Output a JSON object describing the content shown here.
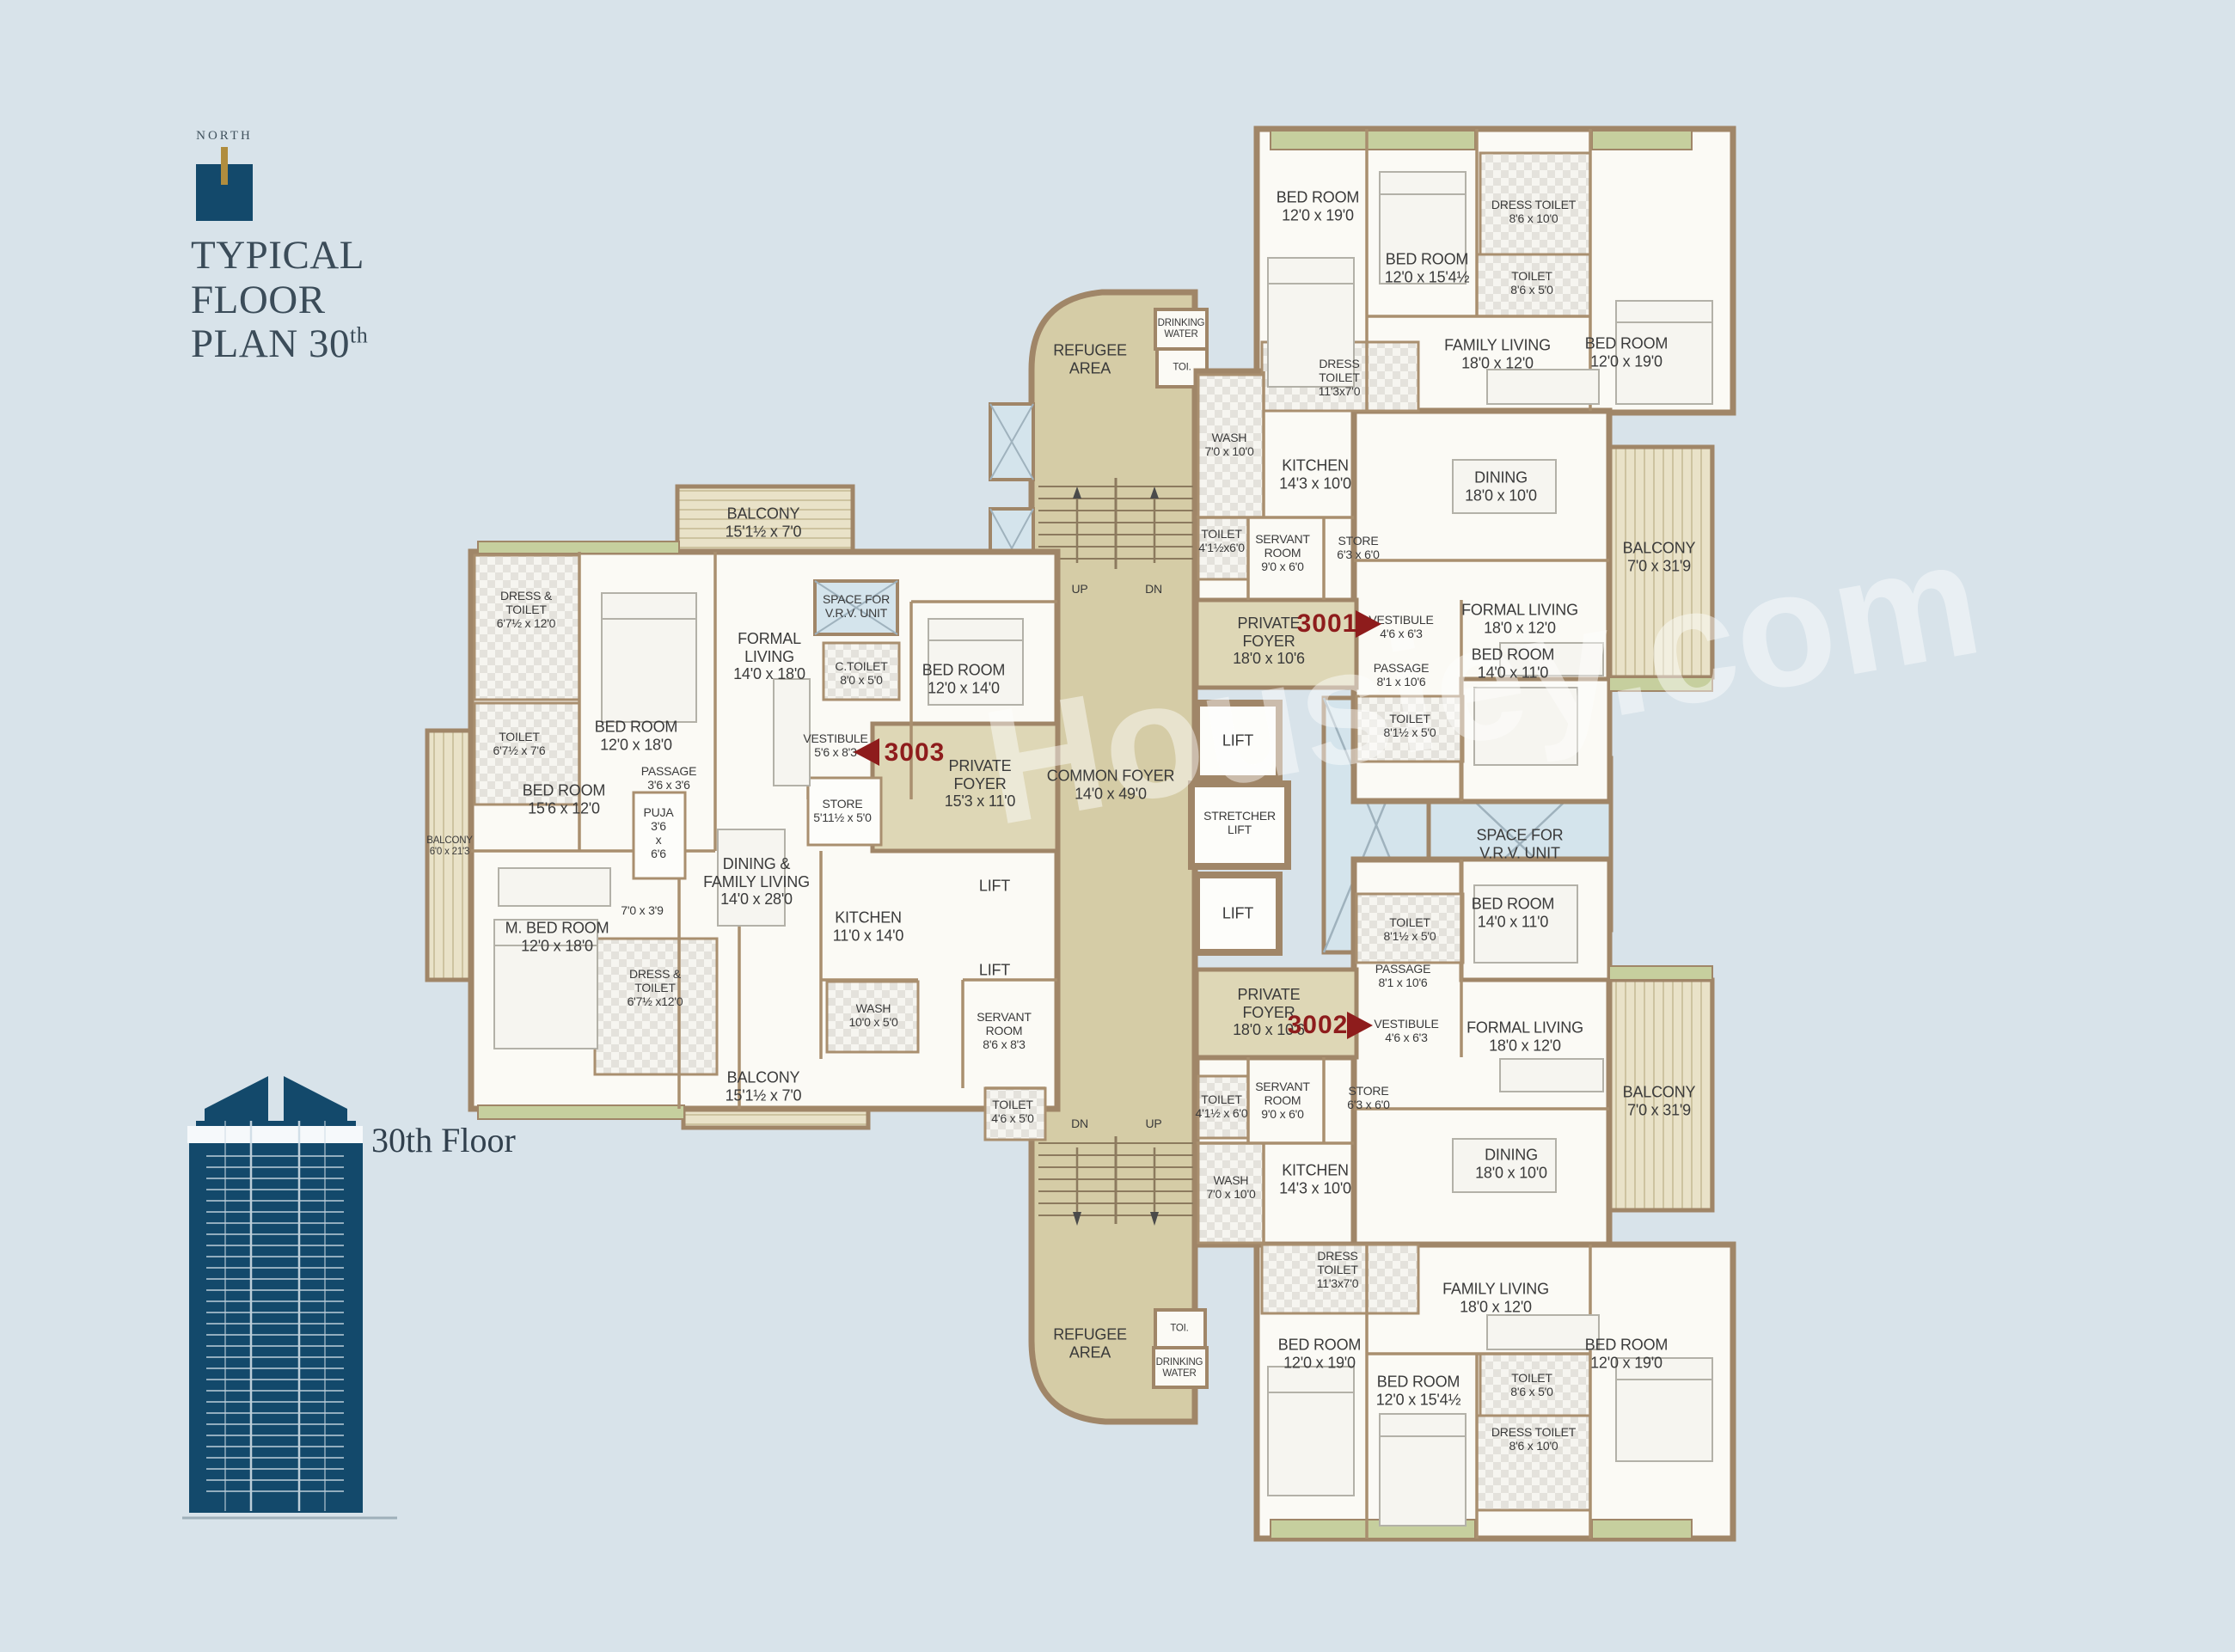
{
  "header": {
    "north_label": "NORTH",
    "title_line1": "TYPICAL",
    "title_line2": "FLOOR",
    "title_line3": "PLAN 30",
    "title_sup": "th"
  },
  "elevation": {
    "caption": "30th Floor"
  },
  "watermark": "Housiey.com",
  "colors": {
    "background": "#d8e3ea",
    "wall_brown": "#a08668",
    "foyer_beige": "#ded7b6",
    "core_beige": "#d5cca6",
    "balcony_cream": "#e9e2c8",
    "planter_green": "#c6cf9e",
    "shaft_blue": "#d4e4ec",
    "unit_number_red": "#8e1c1c",
    "north_navy": "#13496b",
    "title_slate": "#3b4c59"
  },
  "units": {
    "u3001": {
      "number": "3001",
      "rooms": [
        "BED ROOM\n12'0 x 19'0",
        "DRESS TOILET\n8'6 x 10'0",
        "BED ROOM\n12'0 x 15'4½",
        "TOILET\n8'6 x 5'0",
        "BED ROOM\n12'0 x 19'0",
        "FAMILY LIVING\n18'0 x 12'0",
        "DRESS\nTOILET\n11'3x7'0",
        "WASH\n7'0 x 10'0",
        "KITCHEN\n14'3 x 10'0",
        "DINING\n18'0 x 10'0",
        "TOILET\n4'1½x6'0",
        "SERVANT\nROOM\n9'0 x 6'0",
        "STORE\n6'3 x 6'0",
        "BALCONY\n7'0 x 31'9",
        "PRIVATE\nFOYER\n18'0 x 10'6",
        "VESTIBULE\n4'6 x 6'3",
        "FORMAL LIVING\n18'0 x 12'0",
        "PASSAGE\n8'1 x 10'6",
        "BED ROOM\n14'0 x 11'0",
        "TOILET\n8'1½ x 5'0"
      ]
    },
    "u3002": {
      "number": "3002",
      "rooms": [
        "BED ROOM\n14'0 x 11'0",
        "TOILET\n8'1½ x 5'0",
        "PASSAGE\n8'1 x 10'6",
        "PRIVATE\nFOYER\n18'0 x 10'6",
        "VESTIBULE\n4'6 x 6'3",
        "FORMAL LIVING\n18'0 x 12'0",
        "STORE\n6'3 x 6'0",
        "TOILET\n4'1½ x 6'0",
        "SERVANT\nROOM\n9'0 x 6'0",
        "BALCONY\n7'0 x 31'9",
        "DINING\n18'0 x 10'0",
        "KITCHEN\n14'3 x 10'0",
        "WASH\n7'0 x 10'0",
        "DRESS\nTOILET\n11'3x7'0",
        "FAMILY LIVING\n18'0 x 12'0",
        "BED ROOM\n12'0 x 19'0",
        "BED ROOM\n12'0 x 15'4½",
        "TOILET\n8'6 x 5'0",
        "DRESS TOILET\n8'6 x 10'0",
        "BED ROOM\n12'0 x 19'0"
      ]
    },
    "u3003": {
      "number": "3003",
      "rooms": [
        "BALCONY\n15'1½ x 7'0",
        "DRESS &\nTOILET\n6'7½ x 12'0",
        "SPACE FOR\nV.R.V. UNIT",
        "FORMAL\nLIVING\n14'0 x 18'0",
        "C.TOILET\n8'0 x 5'0",
        "BED ROOM\n12'0 x 18'0",
        "TOILET\n6'7½ x 7'6",
        "VESTIBULE\n5'6 x 8'3",
        "BED ROOM\n12'0 x 14'0",
        "PRIVATE\nFOYER\n15'3 x 11'0",
        "PASSAGE\n3'6 x 3'6",
        "BED ROOM\n15'6 x 12'0",
        "PUJA\n3'6\nx\n6'6",
        "STORE\n5'11½ x 5'0",
        "BALCONY\n6'0 x 21'3",
        "DINING &\nFAMILY LIVING\n14'0 x 28'0",
        "7'0 x 3'9",
        "KITCHEN\n11'0 x 14'0",
        "M. BED ROOM\n12'0 x 18'0",
        "DRESS &\nTOILET\n6'7½ x12'0",
        "WASH\n10'0 x 5'0",
        "BALCONY\n15'1½ x 7'0",
        "SERVANT\nROOM\n8'6 x 8'3",
        "TOILET\n4'6 x 5'0"
      ]
    }
  },
  "core": {
    "rooms": [
      "REFUGEE\nAREA",
      "DRINKING\nWATER",
      "TOI.",
      "UP",
      "DN",
      "COMMON FOYER\n14'0 x 49'0",
      "LIFT",
      "STRETCHER\nLIFT",
      "LIFT",
      "LIFT",
      "LIFT",
      "SPACE FOR\nV.R.V. UNIT",
      "DN",
      "UP",
      "TOI.",
      "DRINKING\nWATER",
      "REFUGEE\nAREA"
    ]
  }
}
